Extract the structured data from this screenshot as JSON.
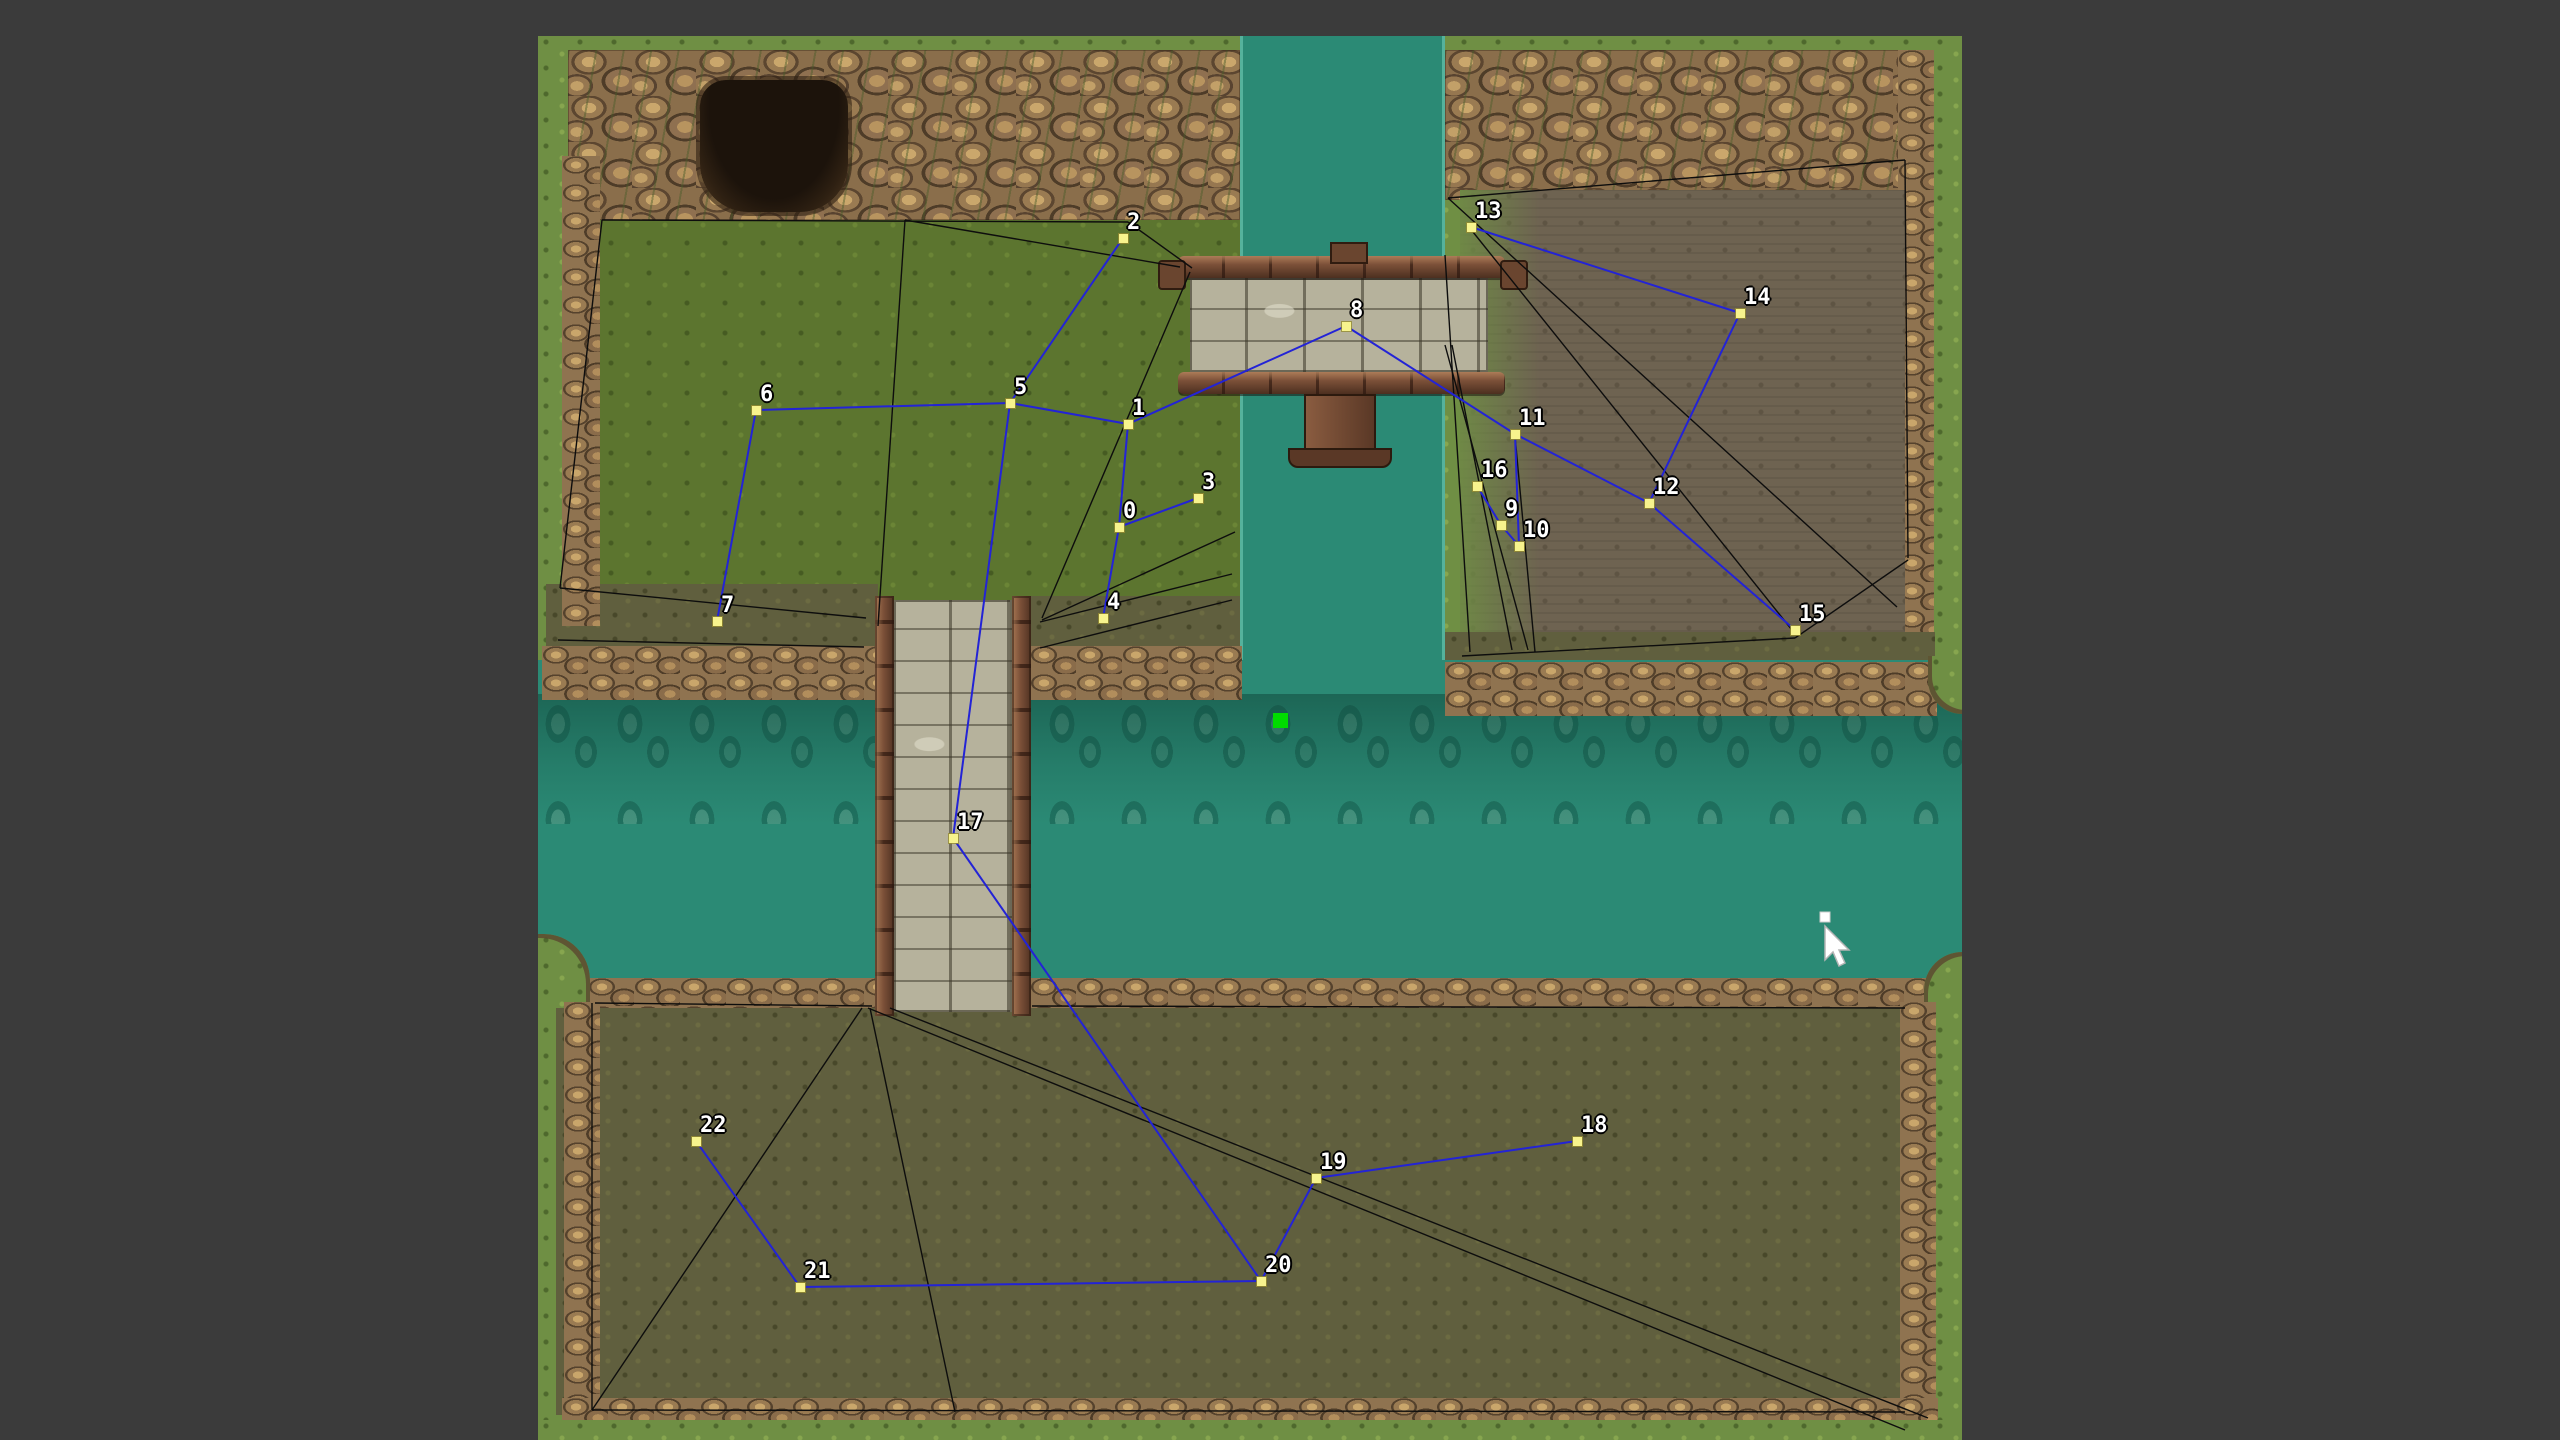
{
  "app": {
    "background_color": "#3b3b3b",
    "description": "Tile map with navigation graph overlay"
  },
  "map": {
    "x": 538,
    "y": 36,
    "width": 1424,
    "height": 1404,
    "colors": {
      "grass_border": "#6f8f44",
      "field_green": "#5c752f",
      "olive_field": "#605f3e",
      "dirt_field": "#6e6351",
      "water": "#2b8a75",
      "rock": "#8a6e4b",
      "bridge_stone": "#b6b29c",
      "bridge_wood": "#7b5038",
      "cave": "#1c130b"
    }
  },
  "graph": {
    "node_color": "#f7f38d",
    "edge_color": "#2323d6",
    "mesh_color": "#0d0d0d",
    "label_color": "#ffffff",
    "nodes": [
      {
        "id": "0",
        "label": "0",
        "x": 1119,
        "y": 527
      },
      {
        "id": "1",
        "label": "1",
        "x": 1128,
        "y": 424
      },
      {
        "id": "2",
        "label": "2",
        "x": 1123,
        "y": 238
      },
      {
        "id": "3",
        "label": "3",
        "x": 1198,
        "y": 498
      },
      {
        "id": "4",
        "label": "4",
        "x": 1103,
        "y": 618
      },
      {
        "id": "5",
        "label": "5",
        "x": 1010,
        "y": 403
      },
      {
        "id": "6",
        "label": "6",
        "x": 756,
        "y": 410
      },
      {
        "id": "7",
        "label": "7",
        "x": 717,
        "y": 621
      },
      {
        "id": "8",
        "label": "8",
        "x": 1346,
        "y": 326
      },
      {
        "id": "9",
        "label": "9",
        "x": 1501,
        "y": 525
      },
      {
        "id": "10",
        "label": "10",
        "x": 1519,
        "y": 546
      },
      {
        "id": "11",
        "label": "11",
        "x": 1515,
        "y": 434
      },
      {
        "id": "12",
        "label": "12",
        "x": 1649,
        "y": 503
      },
      {
        "id": "13",
        "label": "13",
        "x": 1471,
        "y": 227
      },
      {
        "id": "14",
        "label": "14",
        "x": 1740,
        "y": 313
      },
      {
        "id": "15",
        "label": "15",
        "x": 1795,
        "y": 630
      },
      {
        "id": "16",
        "label": "16",
        "x": 1477,
        "y": 486
      },
      {
        "id": "17",
        "label": "17",
        "x": 953,
        "y": 838
      },
      {
        "id": "18",
        "label": "18",
        "x": 1577,
        "y": 1141
      },
      {
        "id": "19",
        "label": "19",
        "x": 1316,
        "y": 1178
      },
      {
        "id": "20",
        "label": "20",
        "x": 1261,
        "y": 1281
      },
      {
        "id": "21",
        "label": "21",
        "x": 800,
        "y": 1287
      },
      {
        "id": "22",
        "label": "22",
        "x": 696,
        "y": 1141
      }
    ],
    "edges": [
      [
        "0",
        "1"
      ],
      [
        "0",
        "3"
      ],
      [
        "0",
        "4"
      ],
      [
        "1",
        "5"
      ],
      [
        "1",
        "8"
      ],
      [
        "2",
        "5"
      ],
      [
        "5",
        "6"
      ],
      [
        "5",
        "17"
      ],
      [
        "6",
        "7"
      ],
      [
        "8",
        "11"
      ],
      [
        "11",
        "12"
      ],
      [
        "11",
        "10"
      ],
      [
        "16",
        "9"
      ],
      [
        "9",
        "10"
      ],
      [
        "12",
        "14"
      ],
      [
        "13",
        "14"
      ],
      [
        "12",
        "15"
      ],
      [
        "17",
        "20"
      ],
      [
        "20",
        "19"
      ],
      [
        "19",
        "18"
      ],
      [
        "20",
        "21"
      ],
      [
        "21",
        "22"
      ]
    ],
    "mesh_segments": [
      [
        602,
        220,
        1128,
        222
      ],
      [
        1128,
        222,
        1192,
        268
      ],
      [
        905,
        220,
        878,
        626
      ],
      [
        905,
        220,
        1180,
        267
      ],
      [
        602,
        220,
        560,
        588
      ],
      [
        560,
        588,
        866,
        618
      ],
      [
        558,
        640,
        864,
        647
      ],
      [
        1042,
        618,
        1190,
        272
      ],
      [
        1042,
        620,
        1235,
        532
      ],
      [
        1040,
        622,
        1232,
        574
      ],
      [
        1040,
        648,
        1232,
        600
      ],
      [
        1448,
        198,
        1905,
        160
      ],
      [
        1905,
        160,
        1908,
        558
      ],
      [
        1448,
        198,
        1897,
        607
      ],
      [
        1473,
        232,
        1792,
        630
      ],
      [
        1445,
        255,
        1470,
        652
      ],
      [
        1445,
        345,
        1528,
        650
      ],
      [
        1452,
        345,
        1512,
        650
      ],
      [
        1515,
        436,
        1535,
        652
      ],
      [
        1462,
        656,
        1795,
        638
      ],
      [
        1795,
        638,
        1908,
        560
      ],
      [
        862,
        1008,
        592,
        1410
      ],
      [
        870,
        1008,
        955,
        1412
      ],
      [
        868,
        1008,
        1905,
        1430
      ],
      [
        890,
        1008,
        1928,
        1418
      ],
      [
        592,
        1410,
        1905,
        1412
      ],
      [
        592,
        1003,
        592,
        1410
      ],
      [
        595,
        1003,
        872,
        1006
      ],
      [
        1032,
        1006,
        1905,
        1008
      ]
    ]
  },
  "overlays": {
    "green_square": {
      "x": 1273,
      "y": 713,
      "size": 15,
      "color": "#00dc00"
    },
    "cursor": {
      "x": 1816,
      "y": 908
    }
  }
}
